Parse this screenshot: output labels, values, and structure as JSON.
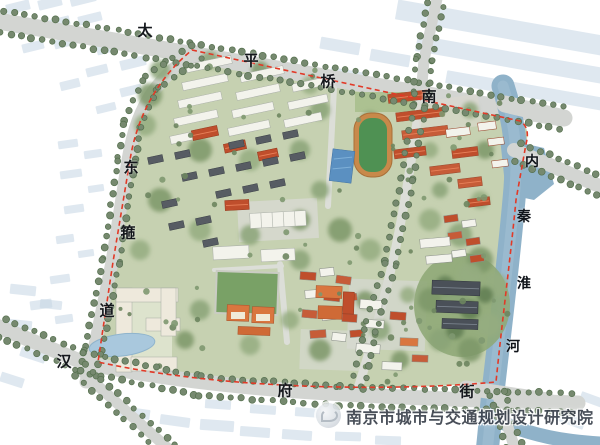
{
  "labels": {
    "top_road": [
      {
        "char": "太"
      },
      {
        "char": "平"
      },
      {
        "char": "桥"
      },
      {
        "char": "南"
      }
    ],
    "west_road": [
      {
        "char": "东"
      },
      {
        "char": "箍"
      },
      {
        "char": "道"
      }
    ],
    "south_road": [
      {
        "char": "汉"
      },
      {
        "char": "府"
      },
      {
        "char": "街"
      }
    ],
    "river": [
      {
        "char": "内"
      },
      {
        "char": "秦"
      },
      {
        "char": "淮"
      },
      {
        "char": "河"
      }
    ]
  },
  "watermark": {
    "text": "南京市城市与交通规划设计研究院"
  },
  "colors": {
    "road": "#d3d5d2",
    "road_minor": "#dcded8",
    "river": "#8fb2c9",
    "river_light": "#a4c1d4",
    "boundary": "#e23927",
    "tree": "#76896f",
    "tree_dark": "#55704e",
    "site_green": "#c3cfad",
    "white_building": "#f3f3ec",
    "red_roof": "#bf4e2c",
    "red_roof_light": "#c65c38",
    "orange_roof": "#d9763f",
    "dark_roof": "#575c63",
    "track_green": "#4f9153",
    "track_ring": "#c8894a",
    "pool_blue": "#5b90c1",
    "pond_blue": "#a9c8dd",
    "ghost_blue": "#c4d5e3",
    "watermark_gray": "#3a414c"
  }
}
